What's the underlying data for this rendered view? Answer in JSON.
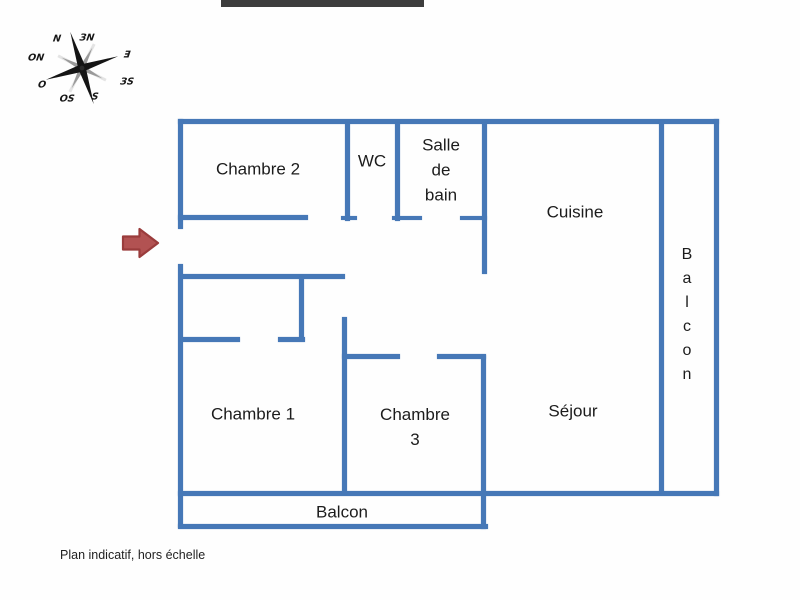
{
  "title_redaction": {
    "present": true,
    "color": "#3d3d3d"
  },
  "ink_color": "#1c1c1c",
  "caption": {
    "text": "Plan indicatif, hors échelle"
  },
  "entrance_arrow": {
    "fill": "#b25252",
    "stroke": "#9a3c3c",
    "direction": "right"
  },
  "compass": {
    "mirrored": true,
    "star_color": "#141414",
    "secondary_color": "#9a9a9a",
    "fan_color": "#d0d0d0",
    "points": [
      {
        "label": "N",
        "x": 39,
        "y": 21
      },
      {
        "label": "ЗN",
        "x": 69,
        "y": 20
      },
      {
        "label": "Ǝ",
        "x": 109,
        "y": 37
      },
      {
        "label": "ЗS",
        "x": 109,
        "y": 64
      },
      {
        "label": "S",
        "x": 77,
        "y": 79
      },
      {
        "label": "OS",
        "x": 49,
        "y": 81
      },
      {
        "label": "O",
        "x": 24,
        "y": 67
      },
      {
        "label": "ON",
        "x": 18,
        "y": 40
      }
    ]
  },
  "floorplan": {
    "wall_color": "#4678b7",
    "room_names": [
      "Chambre 2",
      "WC",
      "Salle de bain",
      "Cuisine",
      "Balcon",
      "Chambre 1",
      "Chambre 3",
      "Séjour",
      "Balcon"
    ],
    "walls": [
      [
        178,
        119,
        541,
        5
      ],
      [
        178,
        119,
        5,
        110
      ],
      [
        178,
        264,
        5,
        264
      ],
      [
        178,
        491,
        541,
        5
      ],
      [
        714,
        119,
        5,
        377
      ],
      [
        659,
        121,
        5,
        372
      ],
      [
        178,
        524,
        310,
        5
      ],
      [
        481,
        355,
        5,
        174
      ],
      [
        178,
        215,
        130,
        5
      ],
      [
        345,
        123,
        5,
        98
      ],
      [
        341,
        216,
        16,
        4
      ],
      [
        395,
        123,
        5,
        98
      ],
      [
        392,
        216,
        30,
        4
      ],
      [
        460,
        216,
        27,
        4
      ],
      [
        482,
        123,
        5,
        151
      ],
      [
        181,
        274,
        164,
        5
      ],
      [
        342,
        317,
        5,
        177
      ],
      [
        342,
        354,
        58,
        5
      ],
      [
        437,
        354,
        49,
        5
      ],
      [
        299,
        277,
        5,
        64
      ],
      [
        181,
        337,
        59,
        5
      ],
      [
        278,
        337,
        27,
        5
      ]
    ],
    "labels": [
      {
        "id": "chambre-2",
        "lines": [
          "Chambre 2"
        ],
        "x": 258,
        "y": 169
      },
      {
        "id": "wc",
        "lines": [
          "WC"
        ],
        "x": 372,
        "y": 161
      },
      {
        "id": "salle-de-bain",
        "lines": [
          "Salle",
          "de",
          "bain"
        ],
        "x": 441,
        "y": 170
      },
      {
        "id": "cuisine",
        "lines": [
          "Cuisine"
        ],
        "x": 575,
        "y": 212
      },
      {
        "id": "chambre-1",
        "lines": [
          "Chambre 1"
        ],
        "x": 253,
        "y": 414
      },
      {
        "id": "chambre-3",
        "lines": [
          "Chambre",
          "3"
        ],
        "x": 415,
        "y": 427
      },
      {
        "id": "sejour",
        "lines": [
          "Séjour"
        ],
        "x": 573,
        "y": 411
      },
      {
        "id": "balcon-sud",
        "lines": [
          "Balcon"
        ],
        "x": 342,
        "y": 512
      },
      {
        "id": "balcon-est",
        "lines": [
          "B",
          "a",
          "l",
          "c",
          "o",
          "n"
        ],
        "x": 687,
        "y": 315,
        "vertical": true
      }
    ]
  }
}
